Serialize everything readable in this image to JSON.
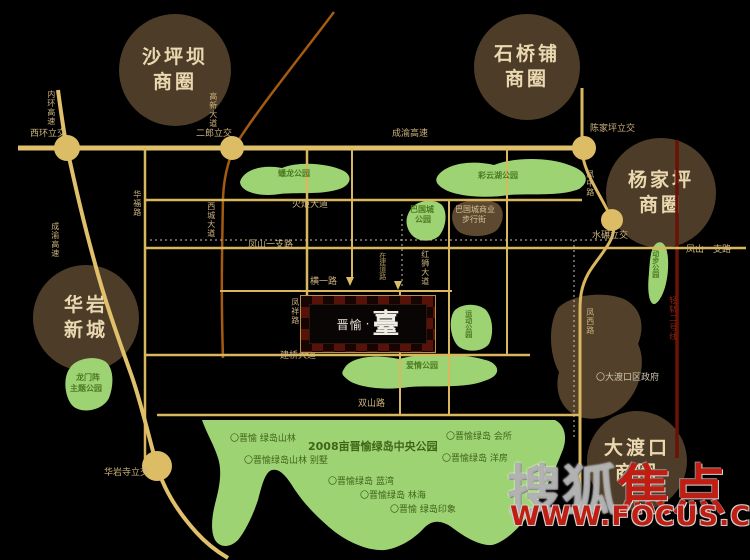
{
  "districts": {
    "shapingba": {
      "line1": "沙坪坝",
      "line2": "商圈"
    },
    "shiqiaopu": {
      "line1": "石桥铺",
      "line2": "商圈"
    },
    "yangjiaping": {
      "line1": "杨家坪",
      "line2": "商圈"
    },
    "huayan": {
      "line1": "华岩",
      "line2": "新城"
    },
    "dadukou": {
      "line1": "大渡口",
      "line2": "商圈"
    }
  },
  "project": {
    "logo_prefix": "晋愉",
    "logo_dot": "·",
    "logo_main": "臺"
  },
  "watermark": {
    "brand_gray": "搜狐",
    "brand_red": "焦点",
    "url": "WWW.FOCUS.CN"
  },
  "colors": {
    "background": "#000000",
    "road_gold": "#d8b75f",
    "expressway_gold": "#e0c06a",
    "rail_line_red": "#6b1206",
    "planned_road_orange": "#a35a12",
    "park_green": "#9ed374",
    "district_circle_brown": "#4d3c27",
    "district_text": "#ead9b0",
    "project_checker_red": "#571209",
    "watermark_red": "#c01e12"
  },
  "map": {
    "labels": [
      {
        "text": "西环立交",
        "x": 30,
        "y": 130,
        "cls": "road"
      },
      {
        "text": "二郎立交",
        "x": 196,
        "y": 130,
        "cls": "road"
      },
      {
        "text": "成渝高速",
        "x": 392,
        "y": 130,
        "cls": "road"
      },
      {
        "text": "陈家坪立交",
        "x": 590,
        "y": 125,
        "cls": "road"
      },
      {
        "text": "水碾立交",
        "x": 592,
        "y": 232,
        "cls": "road"
      },
      {
        "text": "华岩寺立交",
        "x": 104,
        "y": 469,
        "cls": "road"
      },
      {
        "text": "火炬大道",
        "x": 292,
        "y": 201,
        "cls": "road"
      },
      {
        "text": "凤山一支路",
        "x": 248,
        "y": 241,
        "cls": "road"
      },
      {
        "text": "凤山一支路",
        "x": 686,
        "y": 246,
        "cls": "road"
      },
      {
        "text": "横一路",
        "x": 310,
        "y": 278,
        "cls": "road"
      },
      {
        "text": "建桥大道",
        "x": 280,
        "y": 352,
        "cls": "road"
      },
      {
        "text": "双山路",
        "x": 358,
        "y": 400,
        "cls": "road"
      },
      {
        "text": "内环高速",
        "x": 46,
        "y": 90,
        "cls": "roadv"
      },
      {
        "text": "成渝高速",
        "x": 50,
        "y": 222,
        "cls": "roadv"
      },
      {
        "text": "高新大道",
        "x": 208,
        "y": 92,
        "cls": "roadv"
      },
      {
        "text": "华福路",
        "x": 132,
        "y": 190,
        "cls": "roadv"
      },
      {
        "text": "西城大道",
        "x": 206,
        "y": 202,
        "cls": "roadv"
      },
      {
        "text": "凤祥路",
        "x": 290,
        "y": 298,
        "cls": "roadv"
      },
      {
        "text": "红狮大道",
        "x": 420,
        "y": 250,
        "cls": "roadv"
      },
      {
        "text": "在建道路",
        "x": 378,
        "y": 252,
        "cls": "microv"
      },
      {
        "text": "凤中路",
        "x": 585,
        "y": 170,
        "cls": "roadv"
      },
      {
        "text": "凤西路",
        "x": 585,
        "y": 308,
        "cls": "roadv"
      },
      {
        "text": "轻轨二号线",
        "x": 668,
        "y": 296,
        "cls": "railv"
      },
      {
        "text": "蟠龙公园",
        "x": 278,
        "y": 170,
        "cls": "park"
      },
      {
        "text": "彩云湖公园",
        "x": 478,
        "y": 172,
        "cls": "park"
      },
      {
        "text": "巴国城",
        "x": 410,
        "y": 206,
        "cls": "park"
      },
      {
        "text": "公园",
        "x": 415,
        "y": 216,
        "cls": "park"
      },
      {
        "text": "爱情公园",
        "x": 406,
        "y": 362,
        "cls": "park"
      },
      {
        "text": "龙门阵",
        "x": 76,
        "y": 374,
        "cls": "park"
      },
      {
        "text": "主题公园",
        "x": 70,
        "y": 385,
        "cls": "park"
      },
      {
        "text": "动步公园",
        "x": 651,
        "y": 250,
        "cls": "parkv"
      },
      {
        "text": "运动公园",
        "x": 464,
        "y": 310,
        "cls": "parkv"
      },
      {
        "text": "巴国城商业",
        "x": 455,
        "y": 206,
        "cls": "brown"
      },
      {
        "text": "步行街",
        "x": 462,
        "y": 216,
        "cls": "brown"
      },
      {
        "text": "〇晋愉 绿岛山林",
        "x": 230,
        "y": 435,
        "cls": "bullet"
      },
      {
        "text": "〇晋愉绿岛山林 别墅",
        "x": 244,
        "y": 457,
        "cls": "bullet"
      },
      {
        "text": "〇晋愉绿岛 蓝湾",
        "x": 328,
        "y": 478,
        "cls": "bullet"
      },
      {
        "text": "〇晋愉绿岛 林海",
        "x": 360,
        "y": 492,
        "cls": "bullet"
      },
      {
        "text": "〇晋愉 绿岛印象",
        "x": 390,
        "y": 506,
        "cls": "bullet"
      },
      {
        "text": "〇晋愉绿岛 会所",
        "x": 446,
        "y": 433,
        "cls": "bullet"
      },
      {
        "text": "〇晋愉绿岛 洋房",
        "x": 442,
        "y": 455,
        "cls": "bullet"
      },
      {
        "text": "〇大渡口区政府",
        "x": 596,
        "y": 374,
        "cls": "gov"
      },
      {
        "text": "2008亩晋愉绿岛中央公园",
        "x": 308,
        "y": 441,
        "cls": "title"
      }
    ]
  }
}
